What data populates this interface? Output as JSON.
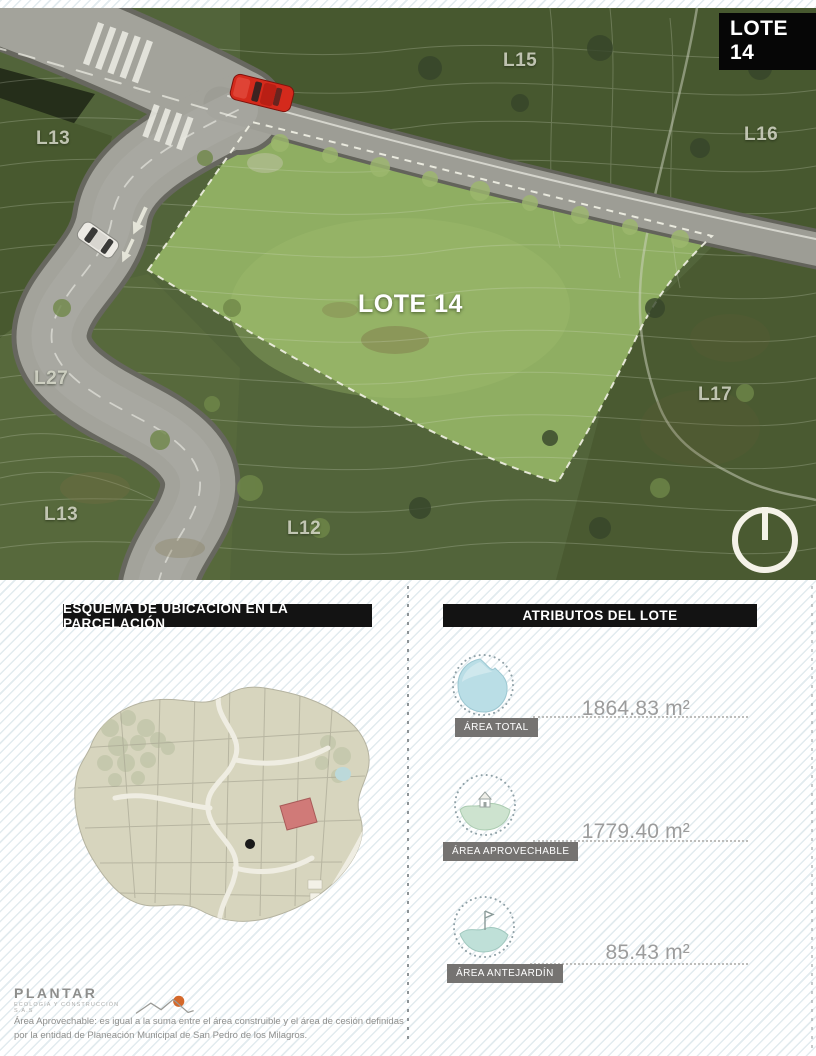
{
  "map": {
    "badge": "LOTE 14",
    "lot_label": "LOTE 14",
    "neighbors": [
      {
        "id": "l13-nw",
        "text": "L13"
      },
      {
        "id": "l15",
        "text": "L15"
      },
      {
        "id": "l16",
        "text": "L16"
      },
      {
        "id": "l27",
        "text": "L27"
      },
      {
        "id": "l17",
        "text": "L17"
      },
      {
        "id": "l13-sw",
        "text": "L13"
      },
      {
        "id": "l12",
        "text": "L12"
      }
    ]
  },
  "sections": {
    "esquema": {
      "title": "ESQUEMA DE UBICACIÓN EN LA PARCELACIÓN"
    },
    "atributos": {
      "title": "ATRIBUTOS DEL LOTE",
      "items": [
        {
          "label": "ÁREA TOTAL",
          "value": "1864.83 m²",
          "icon": "area-total-blob-icon"
        },
        {
          "label": "ÁREA APROVECHABLE",
          "value": "1779.40 m²",
          "icon": "area-aprovechable-house-icon"
        },
        {
          "label": "ÁREA ANTEJARDÍN",
          "value": "85.43 m²",
          "icon": "area-antejardin-flag-icon"
        }
      ]
    }
  },
  "footer": {
    "brand": "PLANTAR",
    "brand_sub": "ECOLOGÍA Y CONSTRUCCIÓN S.A.S",
    "disclaimer": "Área Aprovechable: es igual a la suma entre el área construible y el área de cesión definidas por la entidad de Planeación Municipal de San Pedro de los Milagros."
  },
  "colors": {
    "accent_red": "#d3281e",
    "lot_green": "#8fae62",
    "area_blue": "#badee6",
    "header_bg": "#131313",
    "highlight_lot_red": "#d07a78"
  }
}
